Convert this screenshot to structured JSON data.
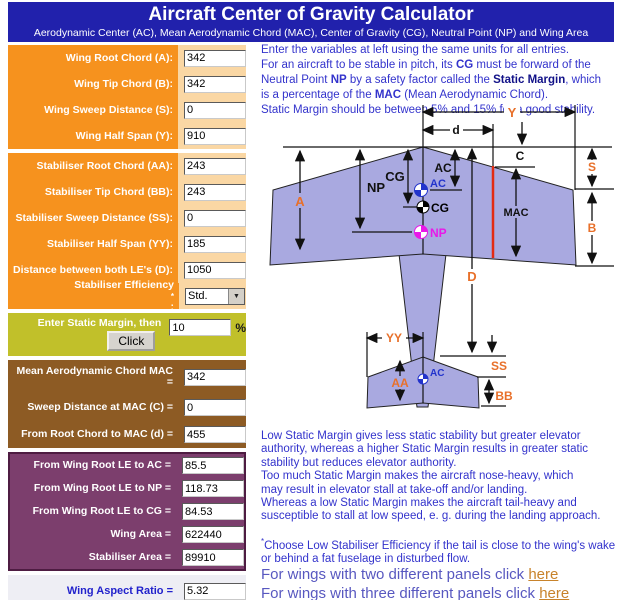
{
  "header": {
    "title": "Aircraft Center of Gravity Calculator",
    "subtitle": "Aerodynamic Center (AC), Mean Aerodynamic Chord (MAC), Center of Gravity (CG), Neutral Point (NP) and Wing Area"
  },
  "panels": {
    "wing": {
      "rows": [
        {
          "name": "wing-root-chord",
          "label": "Wing Root Chord (A):",
          "value": "342"
        },
        {
          "name": "wing-tip-chord",
          "label": "Wing Tip Chord (B):",
          "value": "342"
        },
        {
          "name": "wing-sweep-distance",
          "label": "Wing Sweep Distance (S):",
          "value": "0"
        },
        {
          "name": "wing-half-span",
          "label": "Wing Half Span (Y):",
          "value": "910"
        }
      ]
    },
    "stab": {
      "rows": [
        {
          "name": "stabiliser-root-chord",
          "label": "Stabiliser Root Chord (AA):",
          "value": "243"
        },
        {
          "name": "stabiliser-tip-chord",
          "label": "Stabiliser Tip Chord (BB):",
          "value": "243"
        },
        {
          "name": "stabiliser-sweep-distance",
          "label": "Stabiliser Sweep Distance (SS):",
          "value": "0"
        },
        {
          "name": "stabiliser-half-span",
          "label": "Stabiliser Half Span (YY):",
          "value": "185"
        },
        {
          "name": "distance-between-les",
          "label": "Distance between both LE's (D):",
          "value": "1050"
        },
        {
          "name": "stabiliser-efficiency",
          "label": "Stabiliser Efficiency",
          "sup": "*",
          "suffix": ":",
          "type": "select",
          "value": "Std."
        }
      ]
    },
    "static_margin": {
      "label": "Enter Static Margin, then",
      "button": "Click",
      "value": "10",
      "unit": "%"
    },
    "mac": {
      "rows": [
        {
          "name": "mean-aerodynamic-chord",
          "label": "Mean Aerodynamic Chord MAC",
          "label2": "=",
          "value": "342",
          "tall": true
        },
        {
          "name": "sweep-distance-at-mac",
          "label": "Sweep Distance at MAC (C) =",
          "value": "0"
        },
        {
          "name": "root-chord-to-mac",
          "label": "From Root Chord to MAC (d) =",
          "value": "455"
        }
      ]
    },
    "results": {
      "rows": [
        {
          "name": "wing-root-le-to-ac",
          "label": "From Wing Root LE to AC =",
          "value": "85.5"
        },
        {
          "name": "wing-root-le-to-np",
          "label": "From Wing Root LE to NP =",
          "value": "118.73"
        },
        {
          "name": "wing-root-le-to-cg",
          "label": "From Wing Root LE to CG =",
          "value": "84.53"
        },
        {
          "name": "wing-area",
          "label": "Wing Area =",
          "value": "622440"
        },
        {
          "name": "stabiliser-area",
          "label": "Stabiliser Area =",
          "value": "89910"
        }
      ]
    },
    "aspect": {
      "label": "Wing Aspect Ratio =",
      "value": "5.32"
    }
  },
  "intro": {
    "lines": [
      [
        {
          "t": "Enter the variables at left using the same units for all entries."
        }
      ],
      [
        {
          "t": "For an aircraft to be stable in pitch, its "
        },
        {
          "t": "CG",
          "b": 1
        },
        {
          "t": " must be forward of the"
        }
      ],
      [
        {
          "t": "Neutral Point "
        },
        {
          "t": "NP",
          "b": 1
        },
        {
          "t": " by a safety factor called the "
        },
        {
          "t": "Static Margin",
          "b": 1,
          "c": "#111188"
        },
        {
          "t": ", which"
        }
      ],
      [
        {
          "t": "is a percentage of the "
        },
        {
          "t": "MAC",
          "b": 1
        },
        {
          "t": " (Mean Aerodynamic Chord)."
        }
      ],
      [
        {
          "t": "Static Margin should be between 5% and 15% for a good stability."
        }
      ]
    ]
  },
  "note1": {
    "lines": [
      [
        {
          "t": "Low Static Margin gives less static stability but greater elevator"
        }
      ],
      [
        {
          "t": "authority, whereas a higher Static Margin results in greater static"
        }
      ],
      [
        {
          "t": "stability but reduces elevator authority."
        }
      ],
      [
        {
          "t": "Too much Static Margin makes the aircraft nose-heavy, which"
        }
      ],
      [
        {
          "t": "may result in elevator stall at take-off and/or landing."
        }
      ],
      [
        {
          "t": "Whereas a low Static Margin makes the aircraft tail-heavy and"
        }
      ],
      [
        {
          "t": "susceptible to stall at low speed, e. g. during the landing approach."
        }
      ]
    ]
  },
  "note2": {
    "lines": [
      [
        {
          "t": "*",
          "sup": 1
        },
        {
          "t": "Choose Low Stabiliser Efficiency if the tail is close to the wing's wake"
        }
      ],
      [
        {
          "t": "or behind a fat fuselage in disturbed flow."
        }
      ]
    ]
  },
  "links": {
    "lines": [
      [
        {
          "t": "For wings with two different panels click "
        },
        {
          "t": "here",
          "link": 1
        }
      ],
      [
        {
          "t": "For wings with three different panels click "
        },
        {
          "t": "here",
          "link": 1
        }
      ]
    ]
  },
  "diagram": {
    "labels": {
      "Y": "Y",
      "d": "d",
      "C": "C",
      "S": "S",
      "MAC": "MAC",
      "B": "B",
      "A": "A",
      "NP": "NP",
      "CG": "CG",
      "AC": "AC",
      "D": "D",
      "YY": "YY",
      "SS": "SS",
      "AA": "AA",
      "BB": "BB",
      "marker_ac": "AC",
      "marker_cg": "CG",
      "marker_np": "NP",
      "marker_ac_stab": "AC"
    },
    "colors": {
      "wing_fill": "#A9A9E0",
      "outline": "#222222",
      "mac_line": "#E32B13",
      "dim_label": "#E8702A",
      "ac": "#2233CC",
      "cg": "#000000",
      "np": "#E818E8"
    }
  }
}
